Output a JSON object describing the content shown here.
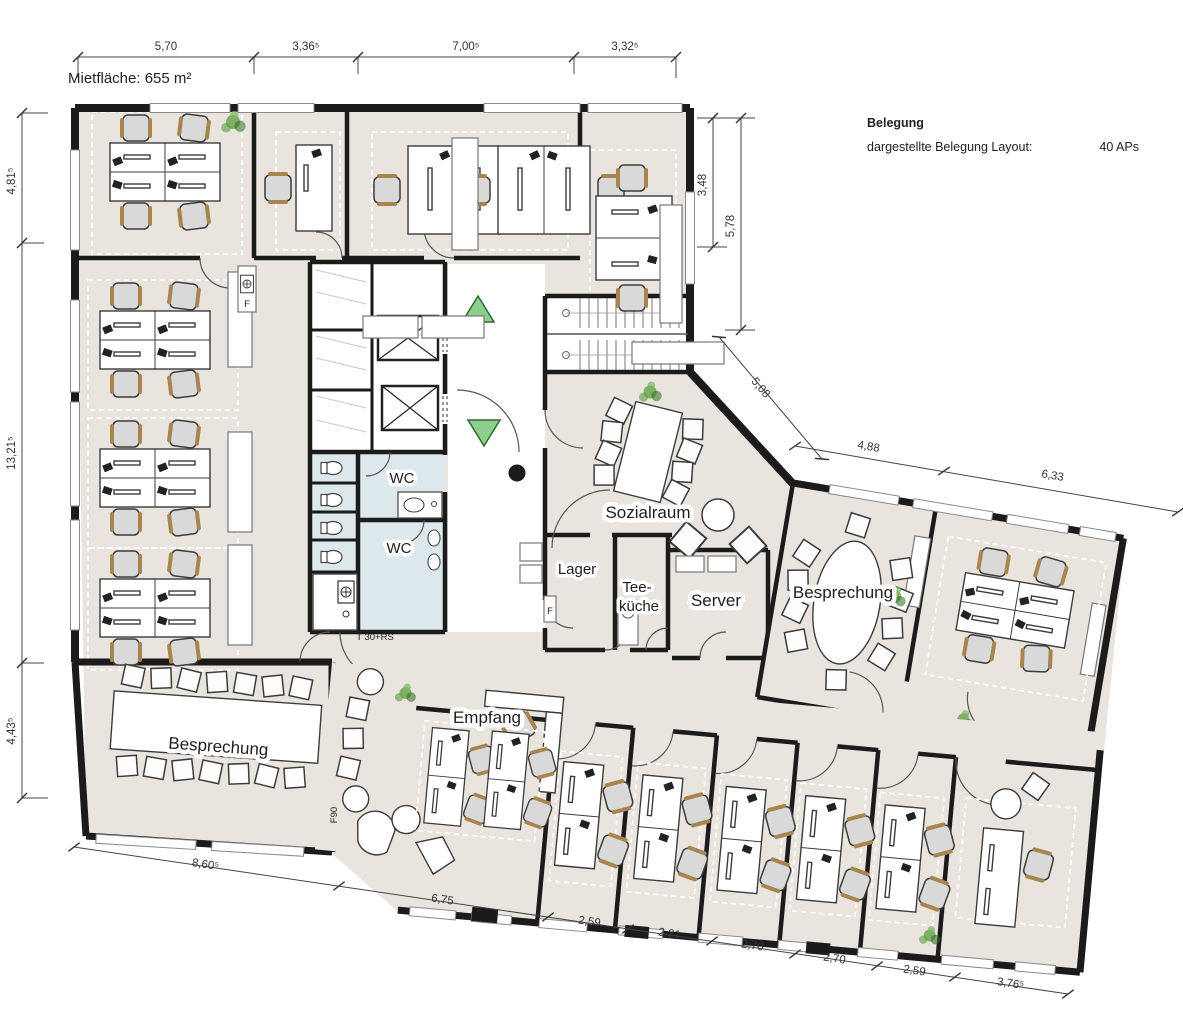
{
  "title": "Mietfläche: 655 m²",
  "legend": {
    "heading": "Belegung",
    "row_label": "dargestellte Belegung Layout:",
    "row_value": "40 APs"
  },
  "rooms": {
    "sozialraum": "Sozialraum",
    "lager": "Lager",
    "teekueche_line1": "Tee-",
    "teekueche_line2": "küche",
    "server": "Server",
    "besprechung_right": "Besprechung",
    "besprechung_left": "Besprechung",
    "empfang": "Empfang",
    "wc_upper": "WC",
    "wc_lower": "WC"
  },
  "annotations": {
    "fire_door": "T 30+RS",
    "f90": "F90",
    "extinguisher_top": "F",
    "extinguisher_lager": "F"
  },
  "dimensions": {
    "top": [
      "5,70",
      "3,36⁵",
      "7,00⁵",
      "3,32⁵"
    ],
    "left": [
      "4,81⁵",
      "13,21⁵",
      "4,43⁵"
    ],
    "right": [
      "3,48",
      "5,78"
    ],
    "diagonal": [
      "5,08",
      "4,88",
      "6,33"
    ],
    "bottom": [
      "8,60⁵",
      "6,75",
      "2,59",
      "2,81",
      "2,70",
      "2,70",
      "2,59",
      "3,76⁵"
    ]
  },
  "colors": {
    "floor": "#e9e4dd",
    "wall": "#1b1b1b",
    "wet_room": "#dde8ec",
    "exit_green": "#8ecf8e",
    "plant_green": "#5d9e42"
  }
}
